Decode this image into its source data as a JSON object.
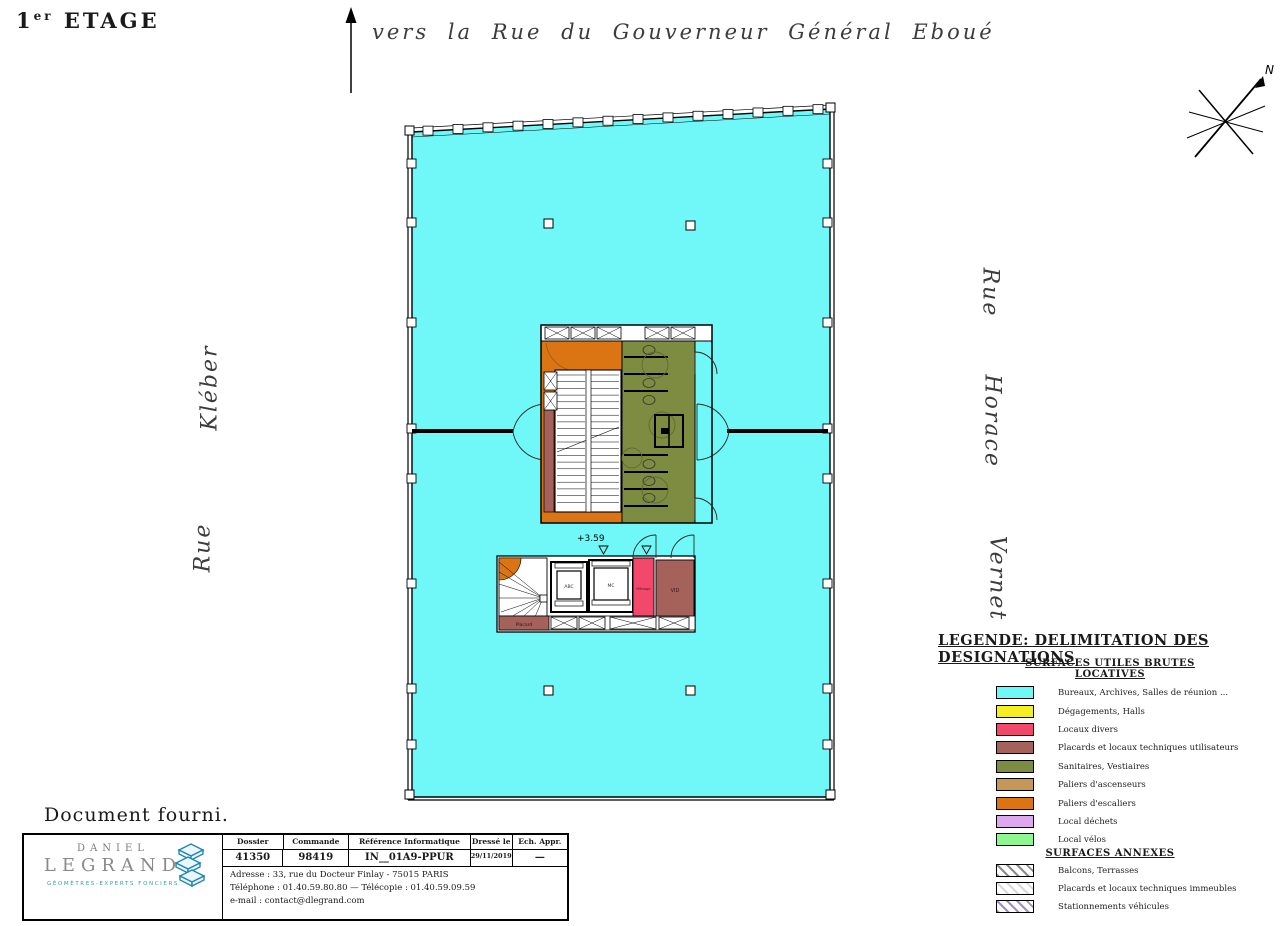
{
  "page": {
    "floor_number": "1",
    "floor_sup": "er",
    "floor_word": "ETAGE",
    "document_note": "Document fourni."
  },
  "streets": {
    "top": "vers la Rue du Gouverneur Général Eboué",
    "left_word1": "Kléber",
    "left_word2": "Rue",
    "right_word1": "Rue",
    "right_word2": "Horace",
    "right_word3": "Vernet"
  },
  "compass": {
    "north": "N"
  },
  "plan": {
    "level": "+3.59",
    "rooms": {
      "elevator_abc": "ABC",
      "elevator_mc": "MC",
      "menage": "Ménage",
      "vid": "VID",
      "placard": "Placard"
    }
  },
  "colors": {
    "cyan": "#70F7F7",
    "yellow": "#F5EE20",
    "pink": "#F2486B",
    "maroon": "#A5625B",
    "olive": "#7E8C42",
    "tan": "#C5985A",
    "orange": "#DB7413",
    "purple": "#DCA9EF",
    "green": "#8FF78F",
    "logo_blue": "#2E9FC4"
  },
  "legend": {
    "title": "LEGENDE: DELIMITATION DES DESIGNATIONS",
    "section1": "SURFACES UTILES BRUTES LOCATIVES",
    "section2": "SURFACES ANNEXES",
    "items": [
      {
        "label": "Bureaux, Archives, Salles de réunion ...",
        "color": "#70F7F7",
        "hatch": false
      },
      {
        "label": "Dégagements, Halls",
        "color": "#F5EE20",
        "hatch": false
      },
      {
        "label": "Locaux divers",
        "color": "#F2486B",
        "hatch": false
      },
      {
        "label": "Placards et locaux techniques utilisateurs",
        "color": "#A5625B",
        "hatch": false
      },
      {
        "label": "Sanitaires, Vestiaires",
        "color": "#7E8C42",
        "hatch": false
      },
      {
        "label": "Paliers d'ascenseurs",
        "color": "#C5985A",
        "hatch": false
      },
      {
        "label": "Paliers d'escaliers",
        "color": "#DB7413",
        "hatch": false
      },
      {
        "label": "Local déchets",
        "color": "#DCA9EF",
        "hatch": false
      },
      {
        "label": "Local vélos",
        "color": "#8FF78F",
        "hatch": false
      }
    ],
    "annex_items": [
      {
        "label": "Balcons, Terrasses",
        "color": "#8a8a8a",
        "hatch": true
      },
      {
        "label": "Placards et locaux techniques immeubles",
        "color": "#d9d9d9",
        "hatch": true
      },
      {
        "label": "Stationnements véhicules",
        "color": "#9f8bc9",
        "hatch": true
      }
    ]
  },
  "title_block": {
    "company": {
      "first": "DANIEL",
      "last": "LEGRAND",
      "tagline": "GÉOMÈTRES-EXPERTS FONCIERS"
    },
    "columns": [
      "Dossier",
      "Commande",
      "Référence Informatique",
      "Dressé le",
      "Ech.  Appr."
    ],
    "values": [
      "41350",
      "98419",
      "IN__01A9-PPUR",
      "29/11/2019",
      "—"
    ],
    "address": "Adresse : 33, rue du Docteur Finlay - 75015 PARIS",
    "phone": "Téléphone : 01.40.59.80.80  —  Télécopie : 01.40.59.09.59",
    "email": "e-mail : contact@dlegrand.com"
  }
}
